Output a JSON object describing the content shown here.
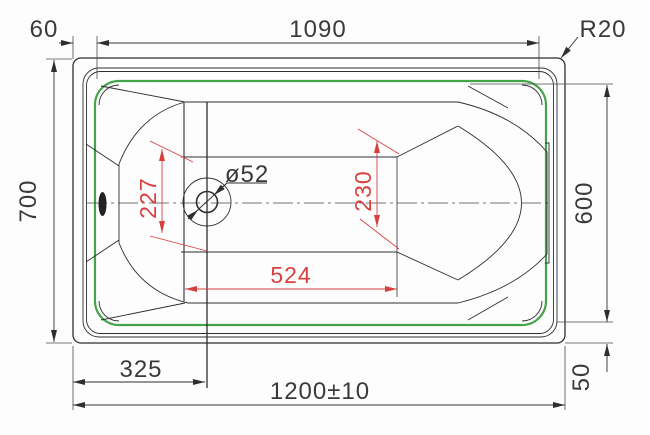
{
  "meta": {
    "type": "technical-drawing",
    "subject": "bathtub-top-view"
  },
  "palette": {
    "line": "#2e2e2e",
    "thin_line": "#4a4a4a",
    "accent_green": "#44a449",
    "dim_red": "#d84040",
    "background": "#fdfdfd"
  },
  "dims": {
    "left_offset": "60",
    "rim_opening_length": "1090",
    "corner_radius": "R20",
    "overall_width": "700",
    "rim_opening_width": "600",
    "overall_length": "1200±10",
    "drain_offset": "325",
    "rim_edge_offset": "50",
    "floor_width_at_drain": "227",
    "floor_width_at_head": "230",
    "floor_length": "524",
    "drain_diameter": "ø52"
  }
}
